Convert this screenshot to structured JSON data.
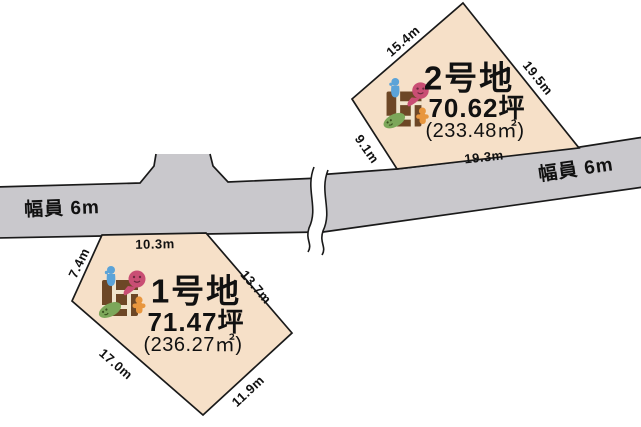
{
  "canvas": {
    "width": 641,
    "height": 427,
    "background": "#ffffff"
  },
  "road": {
    "fill": "#c9c8cc",
    "outline": "#1a1a1a",
    "label_left": "幅員 6m",
    "label_right": "幅員 6m"
  },
  "plots": [
    {
      "name": "1号地",
      "tsubo": "71.47坪",
      "area": "(236.27㎡)",
      "fill": "#f6e0c8",
      "dimensions": {
        "top": "10.3m",
        "upper_left": "7.4m",
        "upper_right": "13.7m",
        "lower_left": "17.0m",
        "lower_right": "11.9m"
      }
    },
    {
      "name": "2号地",
      "tsubo": "70.62坪",
      "area": "(233.48㎡)",
      "fill": "#f6e0c8",
      "dimensions": {
        "upper_left": "15.4m",
        "right": "19.5m",
        "left": "9.1m",
        "bottom": "19.3m"
      }
    }
  ],
  "icon": {
    "semantic": "family-lattice-icon",
    "colors": {
      "lattice_brown": "#6d4726",
      "lattice_line": "#f0e4cc",
      "figure_blue": "#5ba3d8",
      "figure_pink": "#c94e74",
      "figure_pink_dark": "#6b2a3e",
      "figure_green": "#7ca75a",
      "figure_green_dark": "#39511f",
      "figure_orange": "#e8963e"
    }
  }
}
